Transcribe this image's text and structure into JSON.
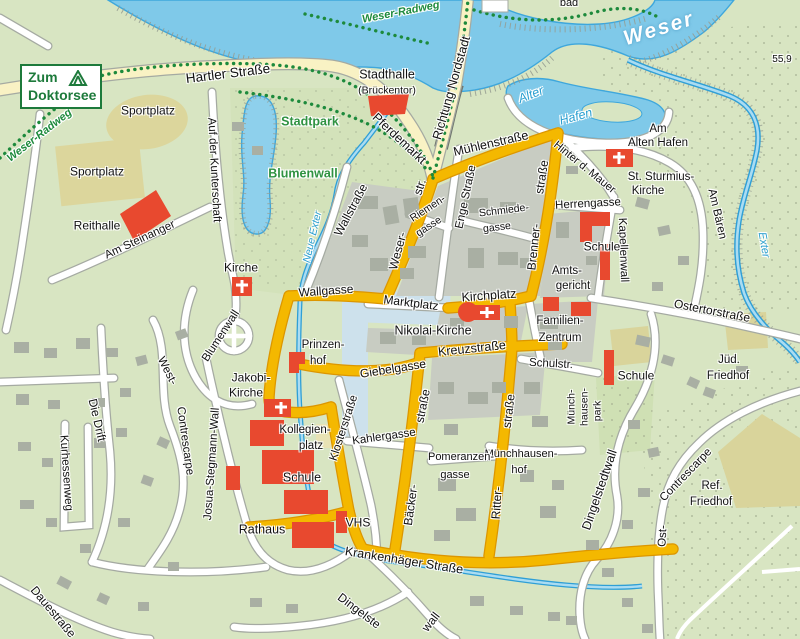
{
  "sign": {
    "line1": "Zum",
    "line2": "Doktorsee"
  },
  "colors": {
    "background": "#d8e5c2",
    "water": "#7fc9e9",
    "water_edge": "#3ea7dc",
    "road_main_gold": "#f4b800",
    "road_secondary_yellow": "#f9f2c4",
    "road_minor": "#ffffff",
    "block_gray": "#c8ccc2",
    "building_gray": "#a9afa3",
    "building_red": "#e8492f",
    "sports_khaki": "#dcd69c",
    "park_label_green": "#2f9241",
    "bike_path_green": "#1d8a3c",
    "water_label_blue": "#2a9fd0",
    "sign_green": "#1d7a3b",
    "plaza_blue": "#cde1ec"
  },
  "labels": [
    {
      "id": "weser-radweg-left",
      "text": "Weser-Radweg",
      "x": 40,
      "y": 136,
      "r": -38,
      "s": 11,
      "c": "t-bike"
    },
    {
      "id": "weser-radweg-top",
      "text": "Weser-Radweg",
      "x": 401,
      "y": 13,
      "r": -11,
      "s": 11,
      "c": "t-bike"
    },
    {
      "id": "hartler-strasse",
      "text": "Hartler  Straße",
      "x": 228,
      "y": 74,
      "r": -7,
      "s": 13.5,
      "c": "t-road"
    },
    {
      "id": "sportplatz-1",
      "text": "Sportplatz",
      "x": 148,
      "y": 111,
      "r": 0,
      "s": 12,
      "c": "t-road"
    },
    {
      "id": "sportplatz-2",
      "text": "Sportplatz",
      "x": 97,
      "y": 172,
      "r": 0,
      "s": 12,
      "c": "t-road"
    },
    {
      "id": "reithalle",
      "text": "Reithalle",
      "x": 97,
      "y": 226,
      "r": 0,
      "s": 12,
      "c": "t-road"
    },
    {
      "id": "am-steinanger",
      "text": "Am  Steinanger",
      "x": 140,
      "y": 240,
      "r": -25,
      "s": 11.5,
      "c": "t-road"
    },
    {
      "id": "auf-der-kunterschaft",
      "text": "Auf der Kunterschaft",
      "x": 214,
      "y": 170,
      "r": 87,
      "s": 11.5,
      "c": "t-road"
    },
    {
      "id": "stadthalle",
      "text": "Stadthalle",
      "x": 387,
      "y": 75,
      "r": 0,
      "s": 12.5,
      "c": "t-road"
    },
    {
      "id": "brueckentor",
      "text": "(Brückentor)",
      "x": 387,
      "y": 91,
      "r": 0,
      "s": 10.5,
      "c": "t-road"
    },
    {
      "id": "richtung-nordstadt",
      "text": "Richtung Nordstadt",
      "x": 452,
      "y": 88,
      "r": -74,
      "s": 12.5,
      "c": "t-road"
    },
    {
      "id": "pferdemarkt",
      "text": "Pferdemarkt",
      "x": 399,
      "y": 139,
      "r": 43,
      "s": 12.5,
      "c": "t-road"
    },
    {
      "id": "stadtpark",
      "text": "Stadtpark",
      "x": 310,
      "y": 122,
      "r": 0,
      "s": 12.5,
      "c": "t-park"
    },
    {
      "id": "blumenwall-green",
      "text": "Blumenwall",
      "x": 303,
      "y": 174,
      "r": 0,
      "s": 12.5,
      "c": "t-park"
    },
    {
      "id": "muehlenstrasse",
      "text": "Mühlenstraße",
      "x": 491,
      "y": 144,
      "r": -13,
      "s": 12.5,
      "c": "t-road"
    },
    {
      "id": "hinter-d-mauer",
      "text": "Hinter d. Mauer",
      "x": 584,
      "y": 168,
      "r": 39,
      "s": 11,
      "c": "t-road"
    },
    {
      "id": "am-alten-hafen-1",
      "text": "Am",
      "x": 658,
      "y": 129,
      "r": 0,
      "s": 11.5,
      "c": "t-road"
    },
    {
      "id": "am-alten-hafen-2",
      "text": "Alten Hafen",
      "x": 658,
      "y": 143,
      "r": 0,
      "s": 11.5,
      "c": "t-road"
    },
    {
      "id": "alter",
      "text": "Alter",
      "x": 531,
      "y": 95,
      "r": -21,
      "s": 12.5,
      "c": "t-water"
    },
    {
      "id": "hafen",
      "text": "Hafen",
      "x": 576,
      "y": 117,
      "r": -15,
      "s": 12.5,
      "c": "t-water"
    },
    {
      "id": "weser",
      "text": "Weser",
      "x": 659,
      "y": 29,
      "r": -17,
      "s": 21,
      "c": "t-weser"
    },
    {
      "id": "bad",
      "text": "bad",
      "x": 569,
      "y": 4,
      "r": 0,
      "s": 11,
      "c": "t-road"
    },
    {
      "id": "height-55-9",
      "text": "55,9",
      "x": 782,
      "y": 60,
      "r": 0,
      "s": 10,
      "c": "t-road"
    },
    {
      "id": "st-sturmius-1",
      "text": "St. Sturmius-",
      "x": 661,
      "y": 177,
      "r": 0,
      "s": 11.5,
      "c": "t-road"
    },
    {
      "id": "st-sturmius-2",
      "text": "Kirche",
      "x": 648,
      "y": 191,
      "r": 0,
      "s": 11.5,
      "c": "t-road"
    },
    {
      "id": "herrengasse",
      "text": "Herrengasse",
      "x": 588,
      "y": 204,
      "r": -3,
      "s": 11.5,
      "c": "t-road"
    },
    {
      "id": "kapellenwall",
      "text": "Kapellenwall",
      "x": 623,
      "y": 250,
      "r": 88,
      "s": 11.5,
      "c": "t-road"
    },
    {
      "id": "schule-ne",
      "text": "Schule",
      "x": 602,
      "y": 247,
      "r": 0,
      "s": 12,
      "c": "t-road"
    },
    {
      "id": "amtsgericht-1",
      "text": "Amts-",
      "x": 567,
      "y": 271,
      "r": 0,
      "s": 11.5,
      "c": "t-road"
    },
    {
      "id": "amtsgericht-2",
      "text": "gericht",
      "x": 573,
      "y": 286,
      "r": 0,
      "s": 11.5,
      "c": "t-road"
    },
    {
      "id": "am-baeren",
      "text": "Am Bären",
      "x": 717,
      "y": 214,
      "r": 77,
      "s": 11.5,
      "c": "t-road"
    },
    {
      "id": "exter",
      "text": "Exter",
      "x": 763,
      "y": 245,
      "r": 80,
      "s": 11,
      "c": "t-water"
    },
    {
      "id": "ostertorstrasse",
      "text": "Ostertorstraße",
      "x": 712,
      "y": 311,
      "r": 11,
      "s": 12,
      "c": "t-road"
    },
    {
      "id": "jued-friedhof-1",
      "text": "Jüd.",
      "x": 729,
      "y": 360,
      "r": 0,
      "s": 11.5,
      "c": "t-road"
    },
    {
      "id": "jued-friedhof-2",
      "text": "Friedhof",
      "x": 728,
      "y": 376,
      "r": 0,
      "s": 11.5,
      "c": "t-road"
    },
    {
      "id": "ref-friedhof-1",
      "text": "Ref.",
      "x": 712,
      "y": 486,
      "r": 0,
      "s": 11.5,
      "c": "t-road"
    },
    {
      "id": "ref-friedhof-2",
      "text": "Friedhof",
      "x": 711,
      "y": 502,
      "r": 0,
      "s": 11.5,
      "c": "t-road"
    },
    {
      "id": "ost-contrescarpe-1",
      "text": "Contrescarpe",
      "x": 686,
      "y": 475,
      "r": -46,
      "s": 11.5,
      "c": "t-road"
    },
    {
      "id": "ost-contrescarpe-2",
      "text": "Ost-",
      "x": 663,
      "y": 536,
      "r": -87,
      "s": 11.5,
      "c": "t-road"
    },
    {
      "id": "dingelstedtwall",
      "text": "Dingelstedtwall",
      "x": 600,
      "y": 490,
      "r": -71,
      "s": 12.5,
      "c": "t-road"
    },
    {
      "id": "muenchhausenpark-1",
      "text": "Münch-",
      "x": 572,
      "y": 407,
      "r": -90,
      "s": 10.5,
      "c": "t-road"
    },
    {
      "id": "muenchhausenpark-2",
      "text": "hausen-",
      "x": 585,
      "y": 407,
      "r": -90,
      "s": 10.5,
      "c": "t-road"
    },
    {
      "id": "muenchhausenpark-3",
      "text": "park",
      "x": 598,
      "y": 411,
      "r": -90,
      "s": 10.5,
      "c": "t-road"
    },
    {
      "id": "muenchhausenhof-1",
      "text": "Münchhausen-",
      "x": 521,
      "y": 455,
      "r": 0,
      "s": 11,
      "c": "t-road"
    },
    {
      "id": "muenchhausenhof-2",
      "text": "hof",
      "x": 519,
      "y": 471,
      "r": 0,
      "s": 11,
      "c": "t-road"
    },
    {
      "id": "schulstr",
      "text": "Schulstr.",
      "x": 551,
      "y": 364,
      "r": 3,
      "s": 11.5,
      "c": "t-road"
    },
    {
      "id": "schule-e",
      "text": "Schule",
      "x": 636,
      "y": 376,
      "r": 0,
      "s": 12,
      "c": "t-road"
    },
    {
      "id": "familien-zentrum-1",
      "text": "Familien-",
      "x": 560,
      "y": 321,
      "r": 0,
      "s": 11.5,
      "c": "t-road"
    },
    {
      "id": "familien-zentrum-2",
      "text": "Zentrum",
      "x": 560,
      "y": 338,
      "r": 0,
      "s": 11.5,
      "c": "t-road"
    },
    {
      "id": "kreuzstrasse",
      "text": "Kreuzstraße",
      "x": 472,
      "y": 349,
      "r": -6,
      "s": 12.5,
      "c": "t-road"
    },
    {
      "id": "nikolai-kirche",
      "text": "Nikolai-Kirche",
      "x": 433,
      "y": 331,
      "r": 0,
      "s": 12.5,
      "c": "t-road"
    },
    {
      "id": "marktplatz",
      "text": "Marktplatz",
      "x": 411,
      "y": 303,
      "r": 7,
      "s": 12,
      "c": "t-road"
    },
    {
      "id": "kirchplatz",
      "text": "Kirchplatz",
      "x": 489,
      "y": 296,
      "r": -4,
      "s": 12.5,
      "c": "t-road"
    },
    {
      "id": "wallgasse",
      "text": "Wallgasse",
      "x": 326,
      "y": 291,
      "r": -4,
      "s": 12,
      "c": "t-road"
    },
    {
      "id": "giebelgasse",
      "text": "Giebelgasse",
      "x": 393,
      "y": 369,
      "r": -9,
      "s": 12,
      "c": "t-road"
    },
    {
      "id": "prinzenhof-1",
      "text": "Prinzen-",
      "x": 323,
      "y": 345,
      "r": 0,
      "s": 11.5,
      "c": "t-road"
    },
    {
      "id": "prinzenhof-2",
      "text": "hof",
      "x": 318,
      "y": 361,
      "r": 0,
      "s": 11.5,
      "c": "t-road"
    },
    {
      "id": "wallstrasse",
      "text": "Wallstraße",
      "x": 351,
      "y": 210,
      "r": -62,
      "s": 12,
      "c": "t-road"
    },
    {
      "id": "neue-exter",
      "text": "Neue Exter",
      "x": 313,
      "y": 237,
      "r": -77,
      "s": 10.5,
      "c": "t-water"
    },
    {
      "id": "weser-str-1",
      "text": "Weser-",
      "x": 398,
      "y": 251,
      "r": -75,
      "s": 12,
      "c": "t-road"
    },
    {
      "id": "weser-str-2",
      "text": "str.",
      "x": 420,
      "y": 187,
      "r": -72,
      "s": 12,
      "c": "t-road"
    },
    {
      "id": "riemengasse-1",
      "text": "Riemen-",
      "x": 428,
      "y": 209,
      "r": -33,
      "s": 10.5,
      "c": "t-road"
    },
    {
      "id": "riemengasse-2",
      "text": "gasse",
      "x": 429,
      "y": 227,
      "r": -33,
      "s": 10.5,
      "c": "t-road"
    },
    {
      "id": "enge-strasse",
      "text": "Enge Straße",
      "x": 466,
      "y": 197,
      "r": -78,
      "s": 11.5,
      "c": "t-road"
    },
    {
      "id": "schmiedegasse-1",
      "text": "Schmiede-",
      "x": 504,
      "y": 211,
      "r": -7,
      "s": 10.5,
      "c": "t-road"
    },
    {
      "id": "schmiedegasse-2",
      "text": "gasse",
      "x": 497,
      "y": 228,
      "r": -7,
      "s": 10.5,
      "c": "t-road"
    },
    {
      "id": "brennerstrasse-1",
      "text": "Brenner-",
      "x": 534,
      "y": 247,
      "r": -84,
      "s": 12,
      "c": "t-road"
    },
    {
      "id": "brennerstrasse-2",
      "text": "straße",
      "x": 542,
      "y": 177,
      "r": -81,
      "s": 12,
      "c": "t-road"
    },
    {
      "id": "blumenwall-curved",
      "text": "Blumenwall",
      "x": 221,
      "y": 336,
      "r": -57,
      "s": 11.5,
      "c": "t-road"
    },
    {
      "id": "kirche-w",
      "text": "Kirche",
      "x": 241,
      "y": 268,
      "r": 0,
      "s": 12,
      "c": "t-road"
    },
    {
      "id": "jakobi-kirche-1",
      "text": "Jakobi-",
      "x": 251,
      "y": 378,
      "r": 0,
      "s": 12,
      "c": "t-road"
    },
    {
      "id": "jakobi-kirche-2",
      "text": "Kirche",
      "x": 246,
      "y": 393,
      "r": 0,
      "s": 12,
      "c": "t-road"
    },
    {
      "id": "kollegienplatz-1",
      "text": "Kollegien-",
      "x": 305,
      "y": 430,
      "r": 0,
      "s": 11.5,
      "c": "t-road"
    },
    {
      "id": "kollegienplatz-2",
      "text": "platz",
      "x": 311,
      "y": 446,
      "r": 0,
      "s": 11.5,
      "c": "t-road"
    },
    {
      "id": "schule-sw",
      "text": "Schule",
      "x": 302,
      "y": 478,
      "r": 0,
      "s": 12.5,
      "c": "t-road"
    },
    {
      "id": "rathaus",
      "text": "Rathaus",
      "x": 262,
      "y": 530,
      "r": 0,
      "s": 12.5,
      "c": "t-road"
    },
    {
      "id": "vhs",
      "text": "VHS",
      "x": 358,
      "y": 523,
      "r": 0,
      "s": 12,
      "c": "t-road"
    },
    {
      "id": "klosterstrasse",
      "text": "Klosterstraße",
      "x": 344,
      "y": 428,
      "r": -72,
      "s": 11.5,
      "c": "t-road"
    },
    {
      "id": "kahlergasse",
      "text": "Kahlergasse",
      "x": 384,
      "y": 437,
      "r": -8,
      "s": 11.5,
      "c": "t-road"
    },
    {
      "id": "baeckerstrasse-1",
      "text": "Bäcker-",
      "x": 411,
      "y": 505,
      "r": -82,
      "s": 12,
      "c": "t-road"
    },
    {
      "id": "baeckerstrasse-2",
      "text": "straße",
      "x": 423,
      "y": 406,
      "r": -79,
      "s": 12,
      "c": "t-road"
    },
    {
      "id": "ritterstrasse-1",
      "text": "Ritter-",
      "x": 497,
      "y": 503,
      "r": -86,
      "s": 12,
      "c": "t-road"
    },
    {
      "id": "ritterstrasse-2",
      "text": "straße",
      "x": 509,
      "y": 411,
      "r": -83,
      "s": 12,
      "c": "t-road"
    },
    {
      "id": "pomeranzengasse-1",
      "text": "Pomeranzen-",
      "x": 461,
      "y": 458,
      "r": 0,
      "s": 11,
      "c": "t-road"
    },
    {
      "id": "pomeranzengasse-2",
      "text": "gasse",
      "x": 455,
      "y": 476,
      "r": 0,
      "s": 11,
      "c": "t-road"
    },
    {
      "id": "josua-stegmann-wall",
      "text": "Josua-Stegmann-Wall",
      "x": 212,
      "y": 464,
      "r": -86,
      "s": 11.5,
      "c": "t-road"
    },
    {
      "id": "west-contrescarpe-1",
      "text": "West-",
      "x": 167,
      "y": 371,
      "r": 63,
      "s": 11.5,
      "c": "t-road"
    },
    {
      "id": "west-contrescarpe-2",
      "text": "Contrescarpe",
      "x": 185,
      "y": 441,
      "r": 82,
      "s": 11.5,
      "c": "t-road"
    },
    {
      "id": "die-drift",
      "text": "Die  Drift",
      "x": 97,
      "y": 420,
      "r": 77,
      "s": 12,
      "c": "t-road"
    },
    {
      "id": "kurhessenweg",
      "text": "Kurhessenweg",
      "x": 66,
      "y": 473,
      "r": 86,
      "s": 11.5,
      "c": "t-road"
    },
    {
      "id": "dauestrasse",
      "text": "Dauestraße",
      "x": 53,
      "y": 612,
      "r": 50,
      "s": 12,
      "c": "t-road"
    },
    {
      "id": "krankenhaeger-strasse",
      "text": "Krankenhäger  Straße",
      "x": 404,
      "y": 561,
      "r": 9,
      "s": 12.5,
      "c": "t-road"
    },
    {
      "id": "dingelste-fragment",
      "text": "Dingelste",
      "x": 359,
      "y": 611,
      "r": 37,
      "s": 12,
      "c": "t-road"
    },
    {
      "id": "wall-fragment",
      "text": "wall",
      "x": 431,
      "y": 622,
      "r": -52,
      "s": 12,
      "c": "t-road"
    }
  ]
}
